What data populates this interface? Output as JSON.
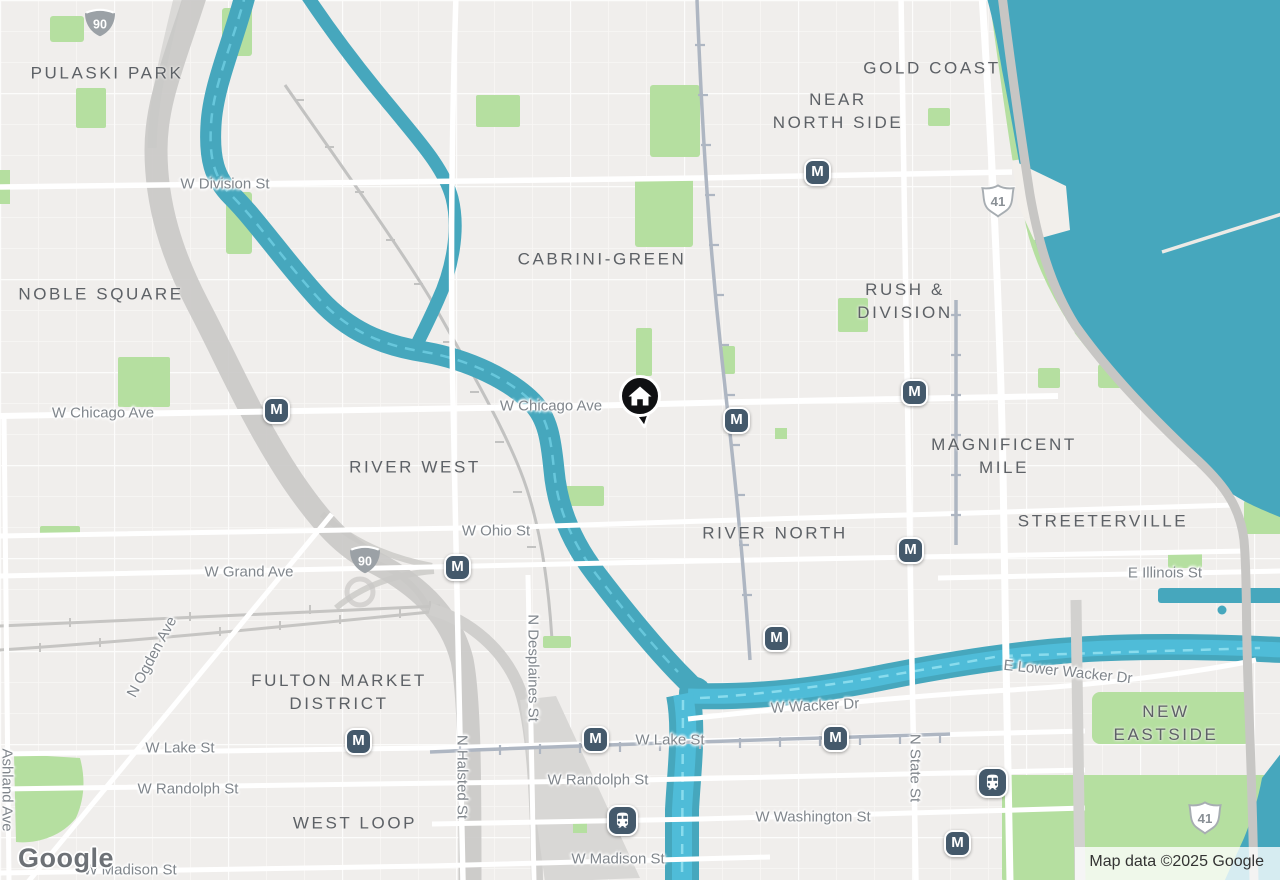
{
  "map": {
    "logo_text": "Google",
    "attribution": "Map data ©2025 Google",
    "transit_badge_letter": "M",
    "colors": {
      "land": "#f0eeec",
      "water": "#46a7bd",
      "water_channel": "#4fbcd8",
      "park": "#b5dfa0",
      "road": "#ffffff",
      "rail_gray": "#c9c8c6",
      "transit_badge": "#44596b",
      "neighborhood_text": "#5d6166",
      "street_text": "#80868c"
    },
    "neighborhoods": [
      {
        "name": "PULASKI PARK",
        "x": 107,
        "y": 73
      },
      {
        "name": "GOLD COAST",
        "x": 932,
        "y": 68
      },
      {
        "name": "NEAR\nNORTH SIDE",
        "x": 838,
        "y": 111
      },
      {
        "name": "NOBLE SQUARE",
        "x": 101,
        "y": 294
      },
      {
        "name": "CABRINI-GREEN",
        "x": 602,
        "y": 259
      },
      {
        "name": "RUSH &\nDIVISION",
        "x": 905,
        "y": 301
      },
      {
        "name": "RIVER WEST",
        "x": 415,
        "y": 467
      },
      {
        "name": "MAGNIFICENT\nMILE",
        "x": 1004,
        "y": 456
      },
      {
        "name": "RIVER NORTH",
        "x": 775,
        "y": 533
      },
      {
        "name": "STREETERVILLE",
        "x": 1103,
        "y": 521
      },
      {
        "name": "FULTON MARKET\nDISTRICT",
        "x": 339,
        "y": 692
      },
      {
        "name": "NEW EASTSIDE",
        "x": 1166,
        "y": 723
      },
      {
        "name": "WEST LOOP",
        "x": 355,
        "y": 823
      }
    ],
    "streets": [
      {
        "name": "W Division St",
        "x": 225,
        "y": 184,
        "rotate": 0
      },
      {
        "name": "W Chicago Ave",
        "x": 103,
        "y": 413,
        "rotate": 0
      },
      {
        "name": "W Chicago Ave",
        "x": 551,
        "y": 406,
        "rotate": 0
      },
      {
        "name": "W Ohio St",
        "x": 496,
        "y": 531,
        "rotate": 0
      },
      {
        "name": "W Grand Ave",
        "x": 249,
        "y": 572,
        "rotate": 0
      },
      {
        "name": "E Illinois St",
        "x": 1165,
        "y": 573,
        "rotate": 0
      },
      {
        "name": "W Lake St",
        "x": 180,
        "y": 748,
        "rotate": 0
      },
      {
        "name": "W Lake St",
        "x": 670,
        "y": 740,
        "rotate": 0
      },
      {
        "name": "W Randolph St",
        "x": 188,
        "y": 789,
        "rotate": 0
      },
      {
        "name": "W Randolph St",
        "x": 598,
        "y": 780,
        "rotate": 0
      },
      {
        "name": "W Washington St",
        "x": 813,
        "y": 817,
        "rotate": 0
      },
      {
        "name": "W Madison St",
        "x": 130,
        "y": 870,
        "rotate": 0
      },
      {
        "name": "W Madison St",
        "x": 618,
        "y": 859,
        "rotate": 0
      },
      {
        "name": "W Wacker Dr",
        "x": 815,
        "y": 706,
        "rotate": -3
      },
      {
        "name": "E Lower Wacker Dr",
        "x": 1068,
        "y": 672,
        "rotate": 6
      },
      {
        "name": "N Ogden Ave",
        "x": 152,
        "y": 657,
        "rotate": -62
      },
      {
        "name": "N Desplaines St",
        "x": 533,
        "y": 668,
        "rotate": 90
      },
      {
        "name": "N Halsted St",
        "x": 462,
        "y": 777,
        "rotate": 90
      },
      {
        "name": "N State St",
        "x": 915,
        "y": 768,
        "rotate": 90
      },
      {
        "name": "Ashland Ave",
        "x": 7,
        "y": 790,
        "rotate": 90
      }
    ],
    "metro_stations": [
      {
        "x": 818,
        "y": 173
      },
      {
        "x": 277,
        "y": 411
      },
      {
        "x": 737,
        "y": 421
      },
      {
        "x": 915,
        "y": 393
      },
      {
        "x": 458,
        "y": 568
      },
      {
        "x": 911,
        "y": 551
      },
      {
        "x": 777,
        "y": 639
      },
      {
        "x": 359,
        "y": 742
      },
      {
        "x": 596,
        "y": 740
      },
      {
        "x": 836,
        "y": 739
      },
      {
        "x": 958,
        "y": 844
      }
    ],
    "rail_stations": [
      {
        "x": 623,
        "y": 821
      },
      {
        "x": 993,
        "y": 783
      }
    ],
    "highway_shields": [
      {
        "system": "interstate",
        "number": "90",
        "x": 100,
        "y": 25
      },
      {
        "system": "interstate",
        "number": "90",
        "x": 365,
        "y": 562
      },
      {
        "system": "us",
        "number": "41",
        "x": 998,
        "y": 203
      },
      {
        "system": "us",
        "number": "41",
        "x": 1205,
        "y": 820
      }
    ],
    "home_marker": {
      "x": 640,
      "y": 396
    }
  }
}
